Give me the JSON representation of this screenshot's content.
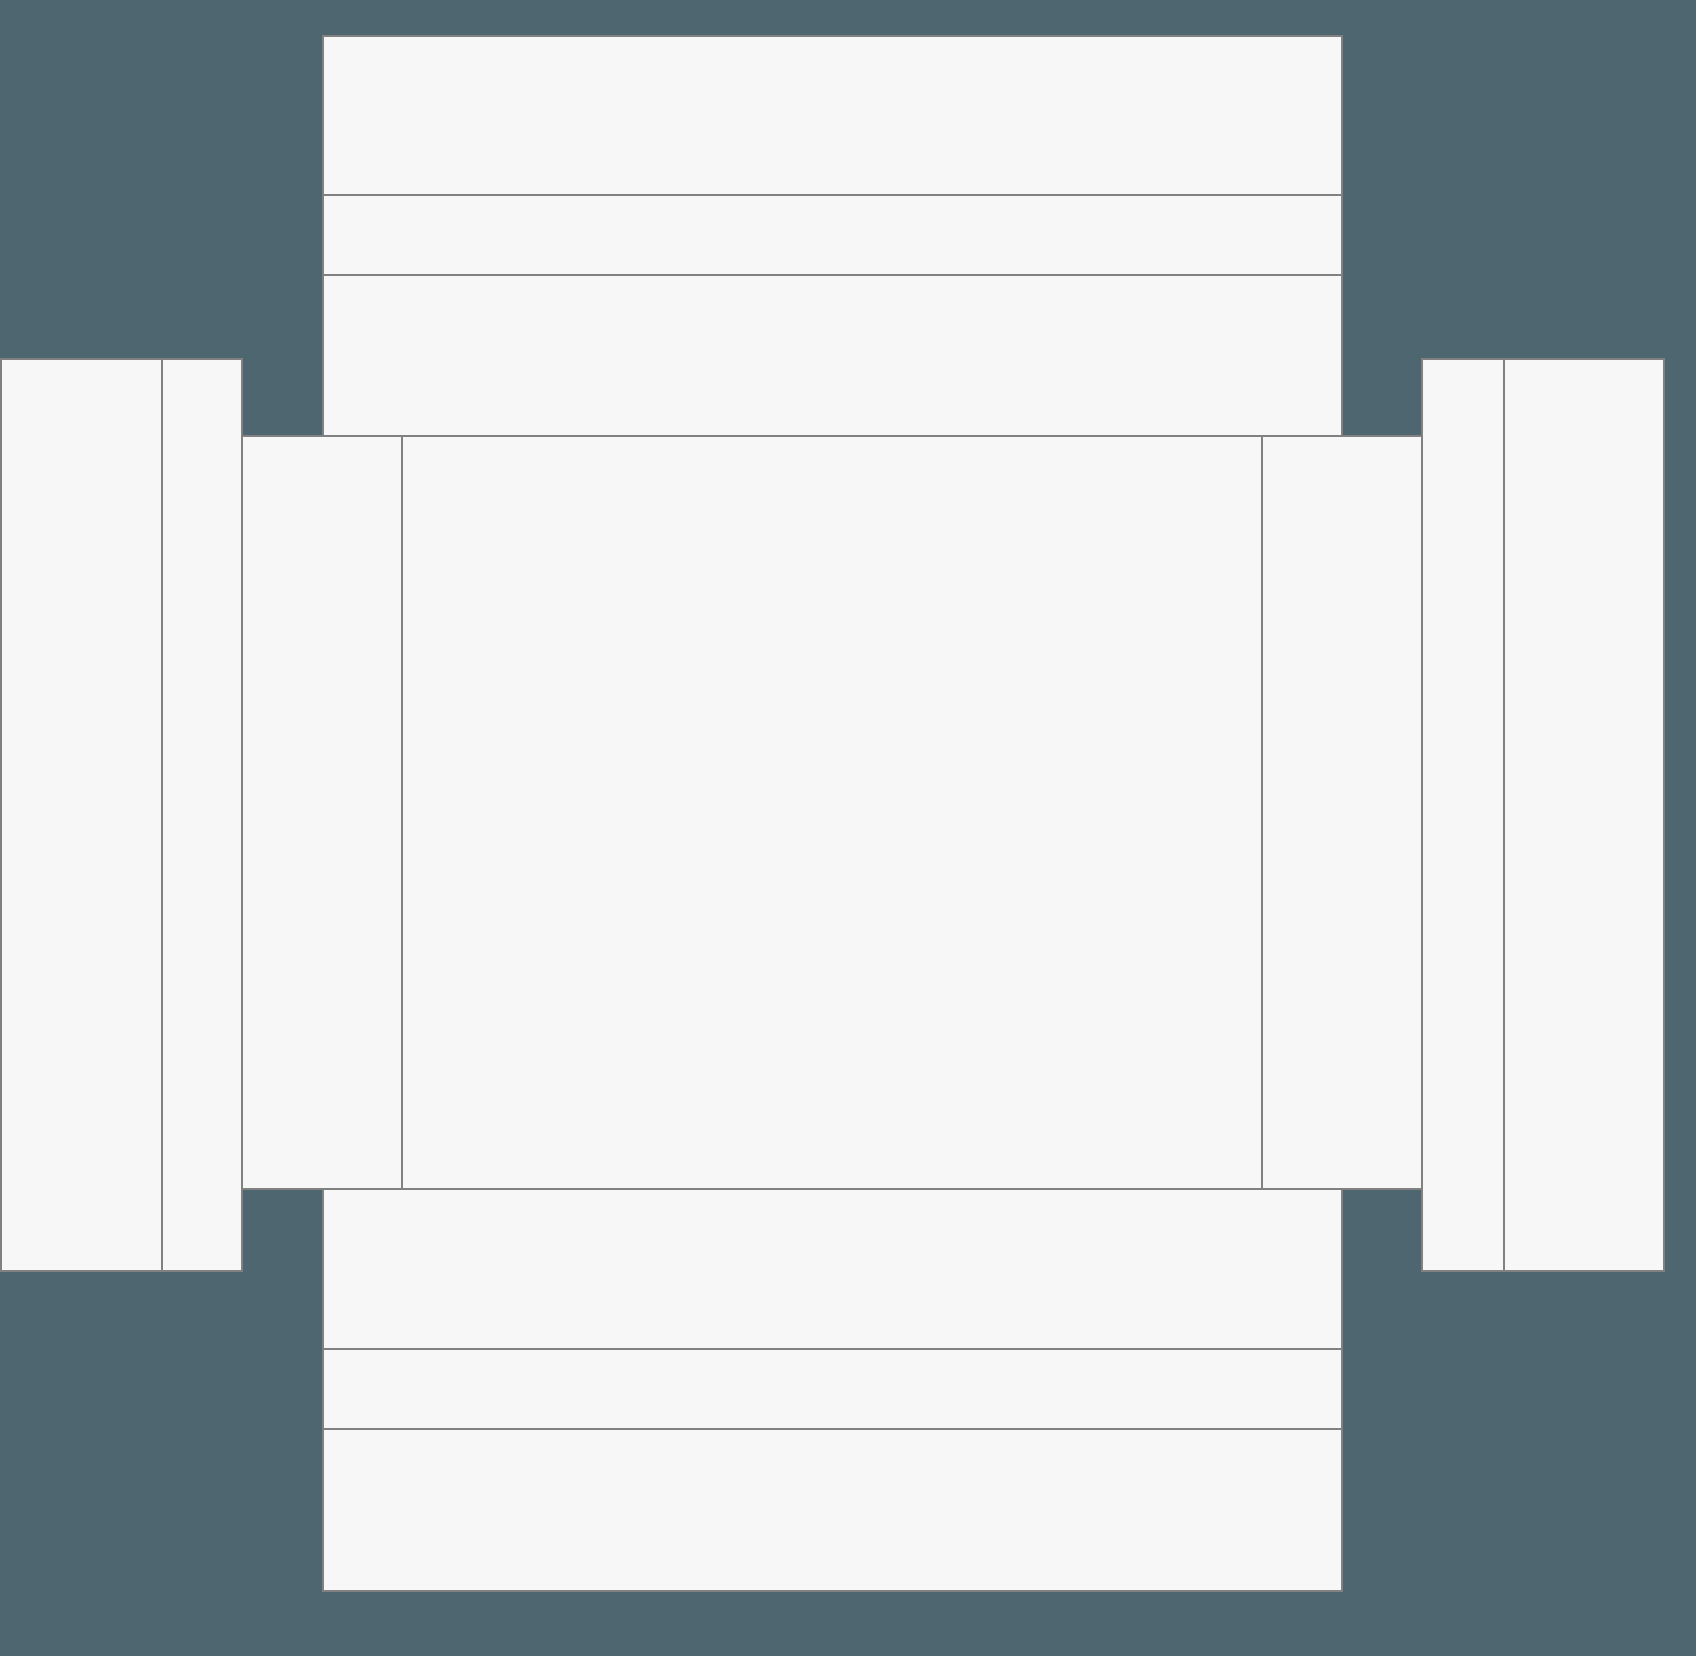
{
  "canvas": {
    "width": 1696,
    "height": 1656,
    "background_color": "#4D6670"
  },
  "style": {
    "panel_fill": "#F7F7F7",
    "line_color": "#818181",
    "line_width": 2
  },
  "panels": [
    {
      "name": "top-flap-block",
      "x": 322,
      "y": 35,
      "w": 1021,
      "h": 404
    },
    {
      "name": "bottom-flap-block",
      "x": 322,
      "y": 1186,
      "w": 1021,
      "h": 406
    },
    {
      "name": "left-outer-strip",
      "x": 0,
      "y": 358,
      "w": 163,
      "h": 914
    },
    {
      "name": "left-inner-strip",
      "x": 161,
      "y": 358,
      "w": 82,
      "h": 914
    },
    {
      "name": "left-side-flap",
      "x": 241,
      "y": 435,
      "w": 162,
      "h": 755
    },
    {
      "name": "center-main-panel",
      "x": 401,
      "y": 435,
      "w": 862,
      "h": 755
    },
    {
      "name": "right-side-flap",
      "x": 1261,
      "y": 435,
      "w": 162,
      "h": 755
    },
    {
      "name": "right-inner-strip",
      "x": 1421,
      "y": 358,
      "w": 84,
      "h": 914
    },
    {
      "name": "right-outer-strip",
      "x": 1503,
      "y": 358,
      "w": 162,
      "h": 914
    }
  ],
  "fold_lines": [
    {
      "name": "top-block-upper-crease",
      "x": 322,
      "y": 194,
      "w": 1021,
      "h": 2
    },
    {
      "name": "top-block-lower-crease",
      "x": 322,
      "y": 274,
      "w": 1021,
      "h": 2
    },
    {
      "name": "bottom-block-upper-crease",
      "x": 322,
      "y": 1348,
      "w": 1021,
      "h": 2
    },
    {
      "name": "bottom-block-lower-crease",
      "x": 322,
      "y": 1428,
      "w": 1021,
      "h": 2
    }
  ]
}
